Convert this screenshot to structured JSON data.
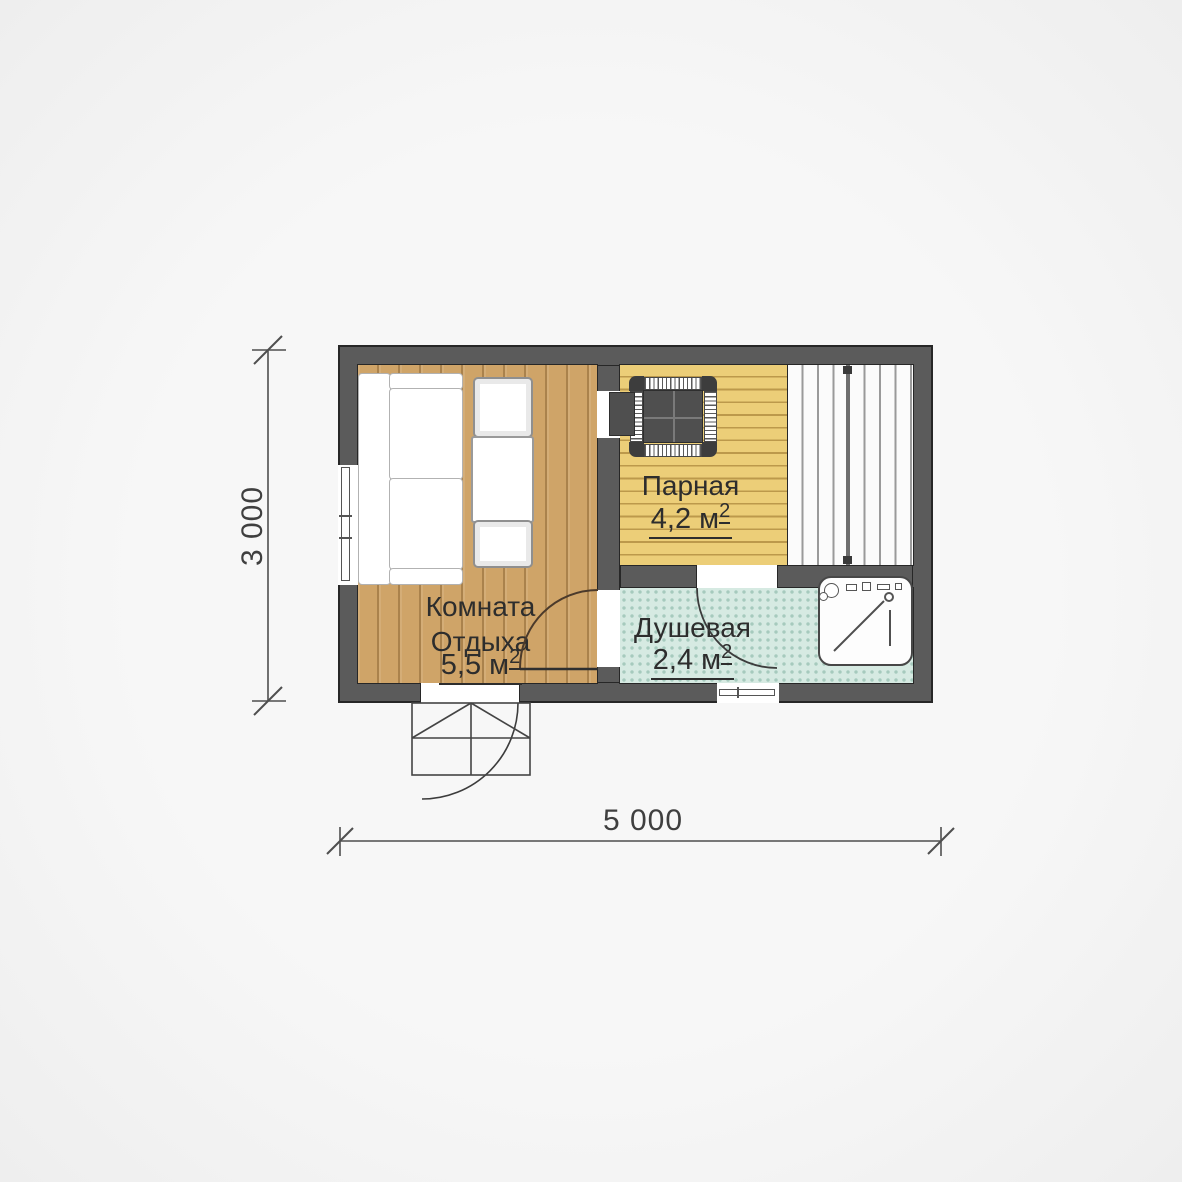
{
  "plan": {
    "title": "sauna-floor-plan",
    "rooms": {
      "rest": {
        "name_line1": "Комната",
        "name_line2": "Отдыха",
        "area_value": "5,5 м",
        "area_sup": "2"
      },
      "steam": {
        "name": "Парная",
        "area_value": "4,2 м",
        "area_sup": "2"
      },
      "shower": {
        "name": "Душевая",
        "area_value": "2,4 м",
        "area_sup": "2"
      }
    },
    "dimensions": {
      "width_label": "5 000",
      "height_label": "3 000"
    },
    "colors": {
      "wall": "#5b5b5b",
      "wall_outline": "#272727",
      "rest_floor_wood": "#cfa468",
      "steam_floor_wood": "#ecce78",
      "bench_planks": "#fbfbfb",
      "shower_tile": "#d6eae2",
      "background": "#f5f5f5",
      "text": "#2d2d2d"
    }
  }
}
